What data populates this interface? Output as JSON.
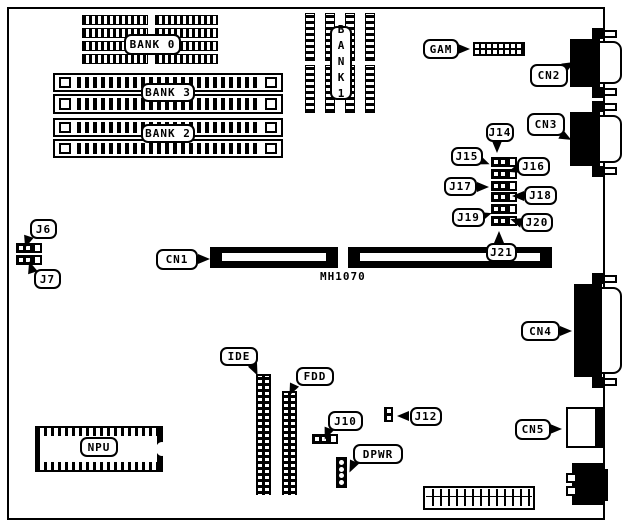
{
  "colors": {
    "ink": "#000000",
    "paper": "#ffffff"
  },
  "board": {
    "model_silkscreen": "MH1070",
    "memory_banks": {
      "bank0": "BANK 0",
      "bank1": "BANK1",
      "bank2": "BANK 2",
      "bank3": "BANK 3"
    },
    "connectors": {
      "cn1": "CN1",
      "cn2": "CN2",
      "cn3": "CN3",
      "cn4": "CN4",
      "cn5": "CN5",
      "gam": "GAM",
      "ide": "IDE",
      "fdd": "FDD",
      "dpwr": "DPWR",
      "npu": "NPU"
    },
    "jumpers": {
      "j6": "J6",
      "j7": "J7",
      "j10": "J10",
      "j12": "J12",
      "j14": "J14",
      "j15": "J15",
      "j16": "J16",
      "j17": "J17",
      "j18": "J18",
      "j19": "J19",
      "j20": "J20",
      "j21": "J21"
    }
  }
}
